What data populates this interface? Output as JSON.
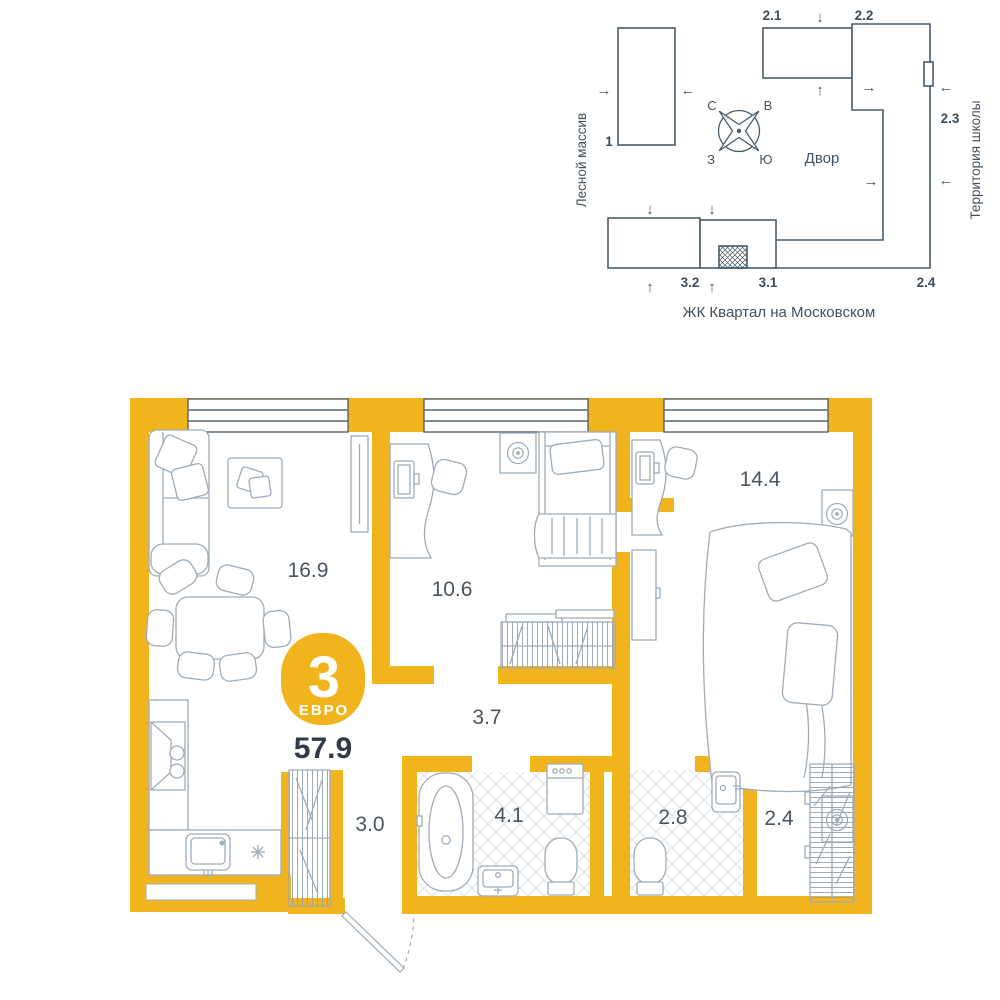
{
  "site": {
    "left_label": "Лесной массив",
    "right_label": "Территория школы",
    "courtyard": "Двор",
    "caption": "ЖК Квартал на Московском",
    "compass": {
      "n": "С",
      "e": "В",
      "s": "Ю",
      "w": "З"
    },
    "buildings": {
      "b1": "1",
      "b21": "2.1",
      "b22": "2.2",
      "b23": "2.3",
      "b24": "2.4",
      "b31": "3.1",
      "b32": "3.2"
    },
    "arrows": {
      "up": "↑",
      "down": "↓",
      "left": "←",
      "right": "→"
    }
  },
  "plan": {
    "badge_number": "3",
    "badge_type": "ЕВРО",
    "total_area": "57.9",
    "rooms": {
      "living": "16.9",
      "bedroom_small": "10.6",
      "bedroom_big": "14.4",
      "hallway": "3.7",
      "hall": "3.0",
      "bathroom": "4.1",
      "toilet": "2.8",
      "wardrobe": "2.4"
    }
  },
  "colors": {
    "accent": "#F2B41C",
    "site_line": "#4A5B68",
    "furniture_line": "#9FACB8",
    "label": "#4A5560"
  }
}
